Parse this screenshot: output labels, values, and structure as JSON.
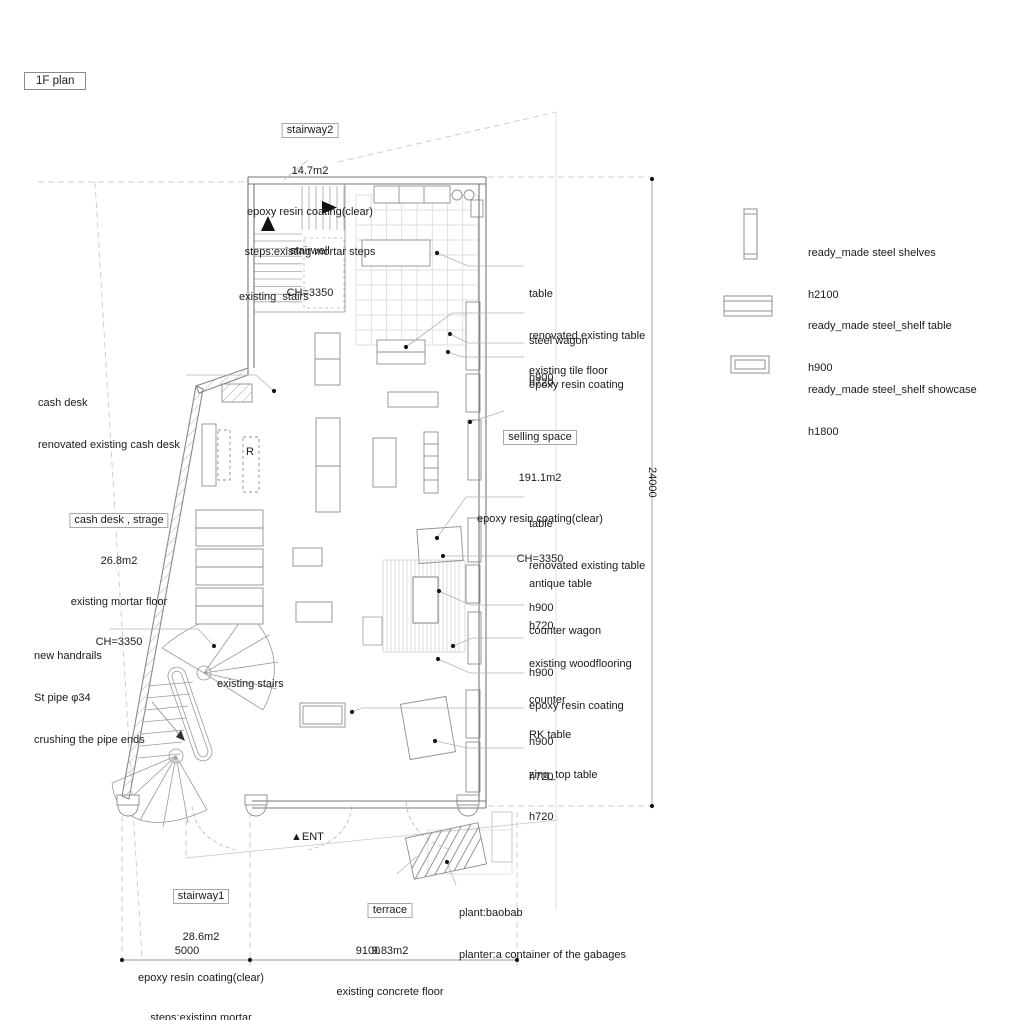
{
  "plan_title": "1F plan",
  "colors": {
    "background": "#ffffff",
    "wall_line": "#777777",
    "furniture_line": "#8f8f8f",
    "grid_line": "#d4d4d4",
    "leader_line": "#b3b3b3",
    "text": "#1a1a1a"
  },
  "rooms": {
    "stairway2": {
      "name": "stairway2",
      "area": "14.7m2",
      "finish": "epoxy resin coating(clear)",
      "steps": "steps:existing mortar steps",
      "ceiling": "CH=3350"
    },
    "selling_space": {
      "name": "selling space",
      "area": "191.1m2",
      "finish": "epoxy resin coating(clear)",
      "ceiling": "CH=3350"
    },
    "cash_desk_storage": {
      "name": "cash desk , strage",
      "area": "26.8m2",
      "finish": "existing mortar floor",
      "ceiling": "CH=3350"
    },
    "stairway1": {
      "name": "stairway1",
      "area": "28.6m2",
      "finish": "epoxy resin coating(clear)",
      "steps": "steps:existing mortar"
    },
    "terrace": {
      "name": "terrace",
      "area": "9.83m2",
      "finish": "existing concrete floor"
    }
  },
  "plan_labels": {
    "stairwell": "stairwell",
    "existing_stairs_upper": "existing  stairs",
    "existing_stairs_lower": "existing stairs",
    "r_mark": "R",
    "entrance": "▲ENT"
  },
  "callouts": {
    "cash_desk": [
      "cash desk",
      "renovated existing cash desk"
    ],
    "new_handrails": [
      "new handrails",
      "St pipe φ34",
      "crushing the pipe ends"
    ],
    "plant": [
      "plant:baobab",
      "planter:a container of the gabages"
    ],
    "right_upper": [
      [
        "table",
        "renovated existing table",
        "h900"
      ],
      [
        "steel wagon",
        "h720"
      ],
      [
        "existing tile floor"
      ],
      [
        "epoxy resin coating"
      ]
    ],
    "right_lower": [
      [
        "table",
        "renovated existing table",
        "h900"
      ],
      [
        "antique table",
        "h720"
      ],
      [
        "counter wagon",
        "h900"
      ],
      [
        "existing woodflooring",
        "epoxy resin coating"
      ],
      [
        "counter",
        "h900"
      ],
      [
        "RK table",
        "h720"
      ],
      [
        "zinq_top table",
        "h720"
      ]
    ]
  },
  "legend": [
    {
      "label": "ready_made steel shelves",
      "height": "h2100"
    },
    {
      "label": "ready_made steel_shelf table",
      "height": "h900"
    },
    {
      "label": "ready_made steel_shelf showcase",
      "height": "h1800"
    }
  ],
  "dimensions": {
    "width_left": "5000",
    "width_right": "9100",
    "height_right": "24000"
  }
}
